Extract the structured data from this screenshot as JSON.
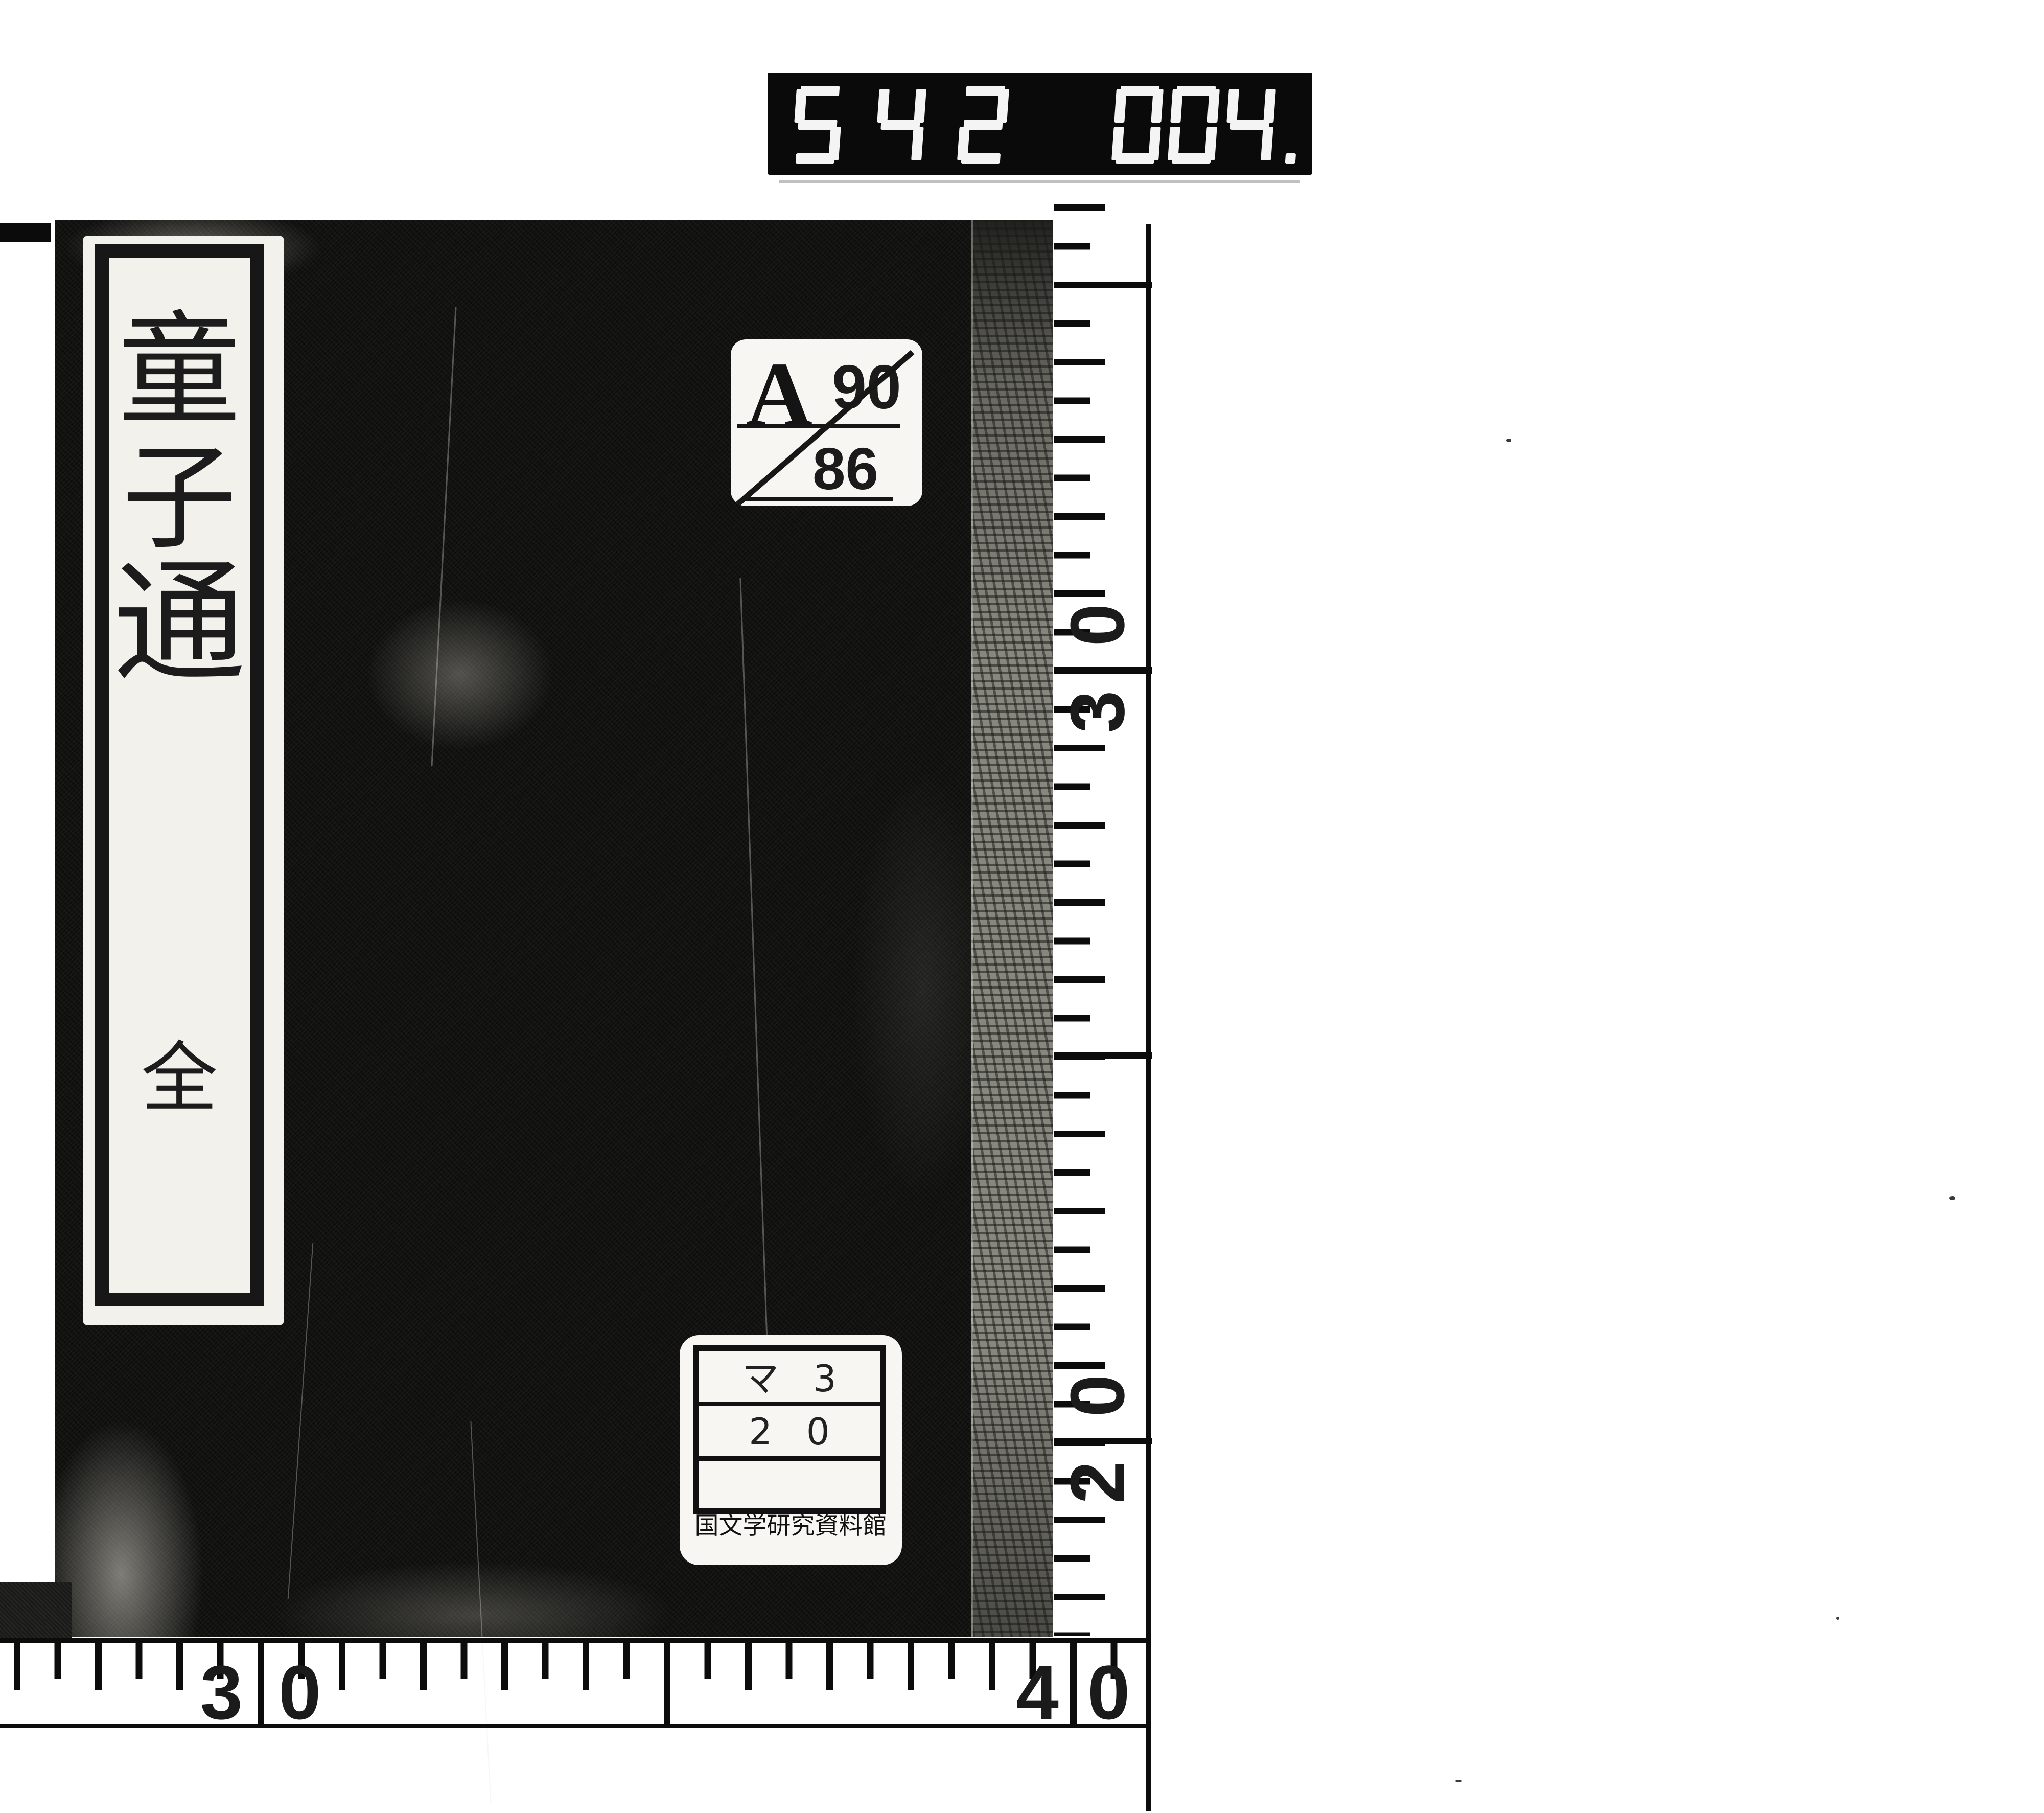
{
  "counter": {
    "group1": "542",
    "group2": "004."
  },
  "book": {
    "title_slip": {
      "title_chars": [
        "童",
        "子",
        "通"
      ],
      "volume_label": "全"
    },
    "classification_label": {
      "letter": "A",
      "crossed_number": "90",
      "number": "86"
    },
    "call_number_label": {
      "row1": "マ 3",
      "row2": "2 0",
      "row3": "",
      "institution": "国文学研究資料館"
    }
  },
  "rulers": {
    "right": {
      "labels": [
        "30",
        "20"
      ]
    },
    "bottom": {
      "labels": [
        "30",
        "40"
      ]
    }
  },
  "colors": {
    "ink": "#111111",
    "paper": "#f6f5f1",
    "cover": "#0e0e0c"
  }
}
